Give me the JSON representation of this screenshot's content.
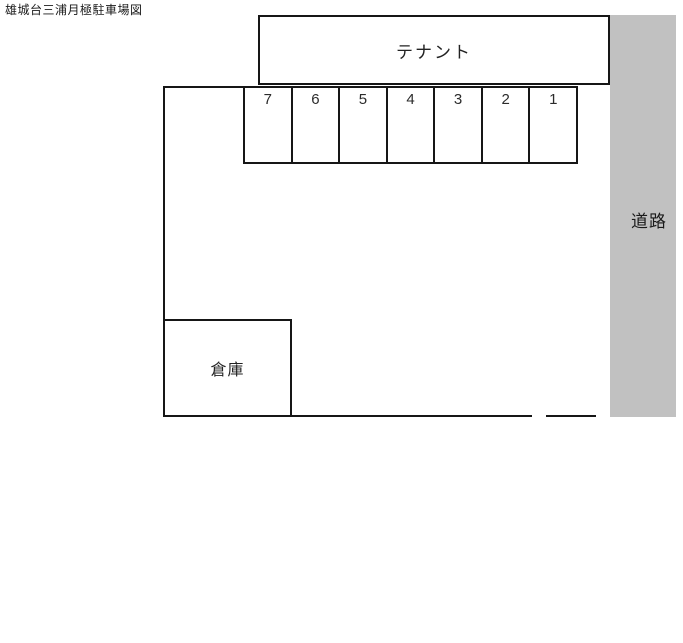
{
  "page": {
    "title": "雄城台三浦月極駐車場図"
  },
  "tenant": {
    "label": "テナント"
  },
  "parking": {
    "space_numbers": [
      "7",
      "6",
      "5",
      "4",
      "3",
      "2",
      "1"
    ]
  },
  "road": {
    "label": "道路",
    "fill_color": "#c1c1c1"
  },
  "warehouse": {
    "label": "倉庫"
  },
  "colors": {
    "line": "#161616",
    "background": "#ffffff"
  }
}
